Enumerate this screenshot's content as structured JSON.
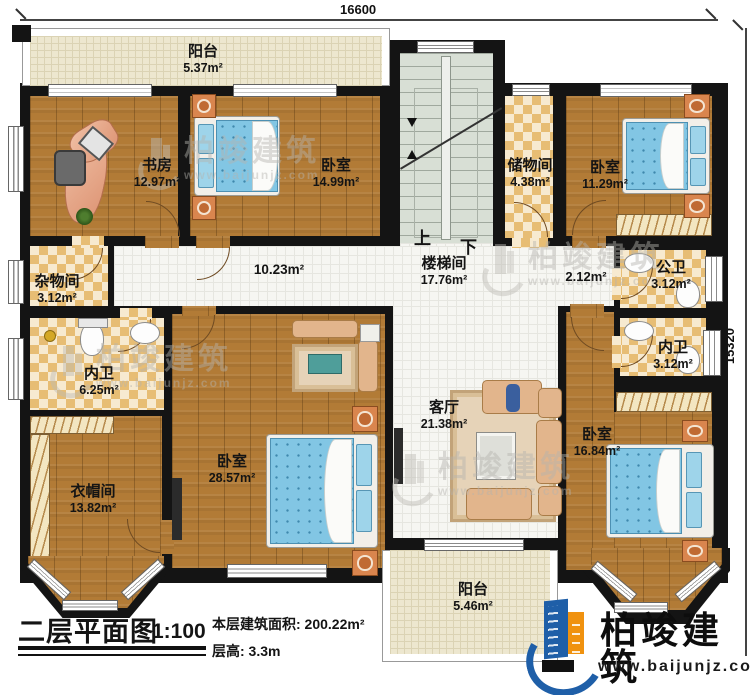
{
  "dimensions": {
    "top_width": "16600",
    "right_height": "15320"
  },
  "stair": {
    "up": "上",
    "down": "下"
  },
  "rooms": {
    "balcony_top": {
      "name": "阳台",
      "area": "5.37m²"
    },
    "study": {
      "name": "书房",
      "area": "12.97m²"
    },
    "bedroom_top_left": {
      "name": "卧室",
      "area": "14.99m²"
    },
    "stairwell": {
      "name": "楼梯间",
      "area": "17.76m²"
    },
    "storage": {
      "name": "储物间",
      "area": "4.38m²"
    },
    "bedroom_top_right": {
      "name": "卧室",
      "area": "11.29m²"
    },
    "utility": {
      "name": "杂物间",
      "area": "3.12m²"
    },
    "corridor": {
      "area": "10.23m²"
    },
    "corridor_right": {
      "area": "2.12m²"
    },
    "public_bath": {
      "name": "公卫",
      "area": "3.12m²"
    },
    "ensuite_right": {
      "name": "内卫",
      "area": "3.12m²"
    },
    "ensuite_left": {
      "name": "内卫",
      "area": "6.25m²"
    },
    "cloakroom": {
      "name": "衣帽间",
      "area": "13.82m²"
    },
    "bedroom_master": {
      "name": "卧室",
      "area": "28.57m²"
    },
    "living_room": {
      "name": "客厅",
      "area": "21.38m²"
    },
    "bedroom_bottom_right": {
      "name": "卧室",
      "area": "16.84m²"
    },
    "balcony_bottom": {
      "name": "阳台",
      "area": "5.46m²"
    }
  },
  "title_block": {
    "title": "二层平面图",
    "scale": "1:100",
    "floor_area": "本层建筑面积: 200.22m²",
    "floor_height": "层高: 3.3m"
  },
  "branding": {
    "name": "柏竣建筑",
    "website": "www.baijunjz.com"
  },
  "watermark": {
    "name": "柏竣建筑",
    "website": "www.baijunjz.com"
  },
  "colors": {
    "wall": "#141414",
    "wood": "#b27b36",
    "tile": "#f6f6f2",
    "checker": "#e7bd74",
    "stair": "#d8dfd5",
    "balcony": "#ede7cf",
    "bed": "#82c6e4",
    "logo_blue": "#1f5fa8",
    "logo_orange": "#f0920f"
  }
}
